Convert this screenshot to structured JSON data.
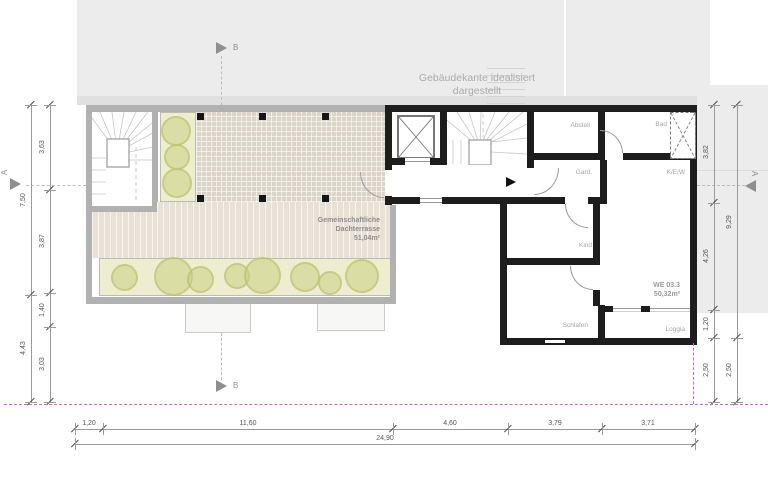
{
  "notes": {
    "building_edge_line1": "Gebäudekante idealisiert",
    "building_edge_line2": "dargestellt"
  },
  "terrace": {
    "label_line1": "Gemeinschaftliche",
    "label_line2": "Dachterrasse",
    "area": "51,04m²"
  },
  "apartment": {
    "id": "WE 03.3",
    "area": "50,32m²",
    "rooms": {
      "abstell": "Abstell",
      "bad": "Bad",
      "gard": "Gard.",
      "kew": "K/E/W",
      "kind": "Kind",
      "schlafen": "Schlafen",
      "loggia": "Loggia"
    }
  },
  "sections": {
    "a": "A",
    "b": "B"
  },
  "dimensions": {
    "left_inner": [
      "3,63",
      "3,87",
      "1,40",
      "3,03"
    ],
    "left_outer": [
      "7,50",
      "4,43"
    ],
    "right_inner": [
      "3,82",
      "4,26",
      "1,20",
      "2,50"
    ],
    "right_outer": [
      "9,29",
      "2,50"
    ],
    "bottom": [
      "1,20",
      "11,60",
      "4,60",
      "3,79",
      "3,71"
    ],
    "bottom_total": "24,90"
  },
  "colors": {
    "wall": "#1d1d1d",
    "terrace_wall": "#b1b1b1",
    "context_gray": "#ececec",
    "deck": "#e8e1d5",
    "planter": "#ededcf",
    "bush": "#cbd182",
    "property_line": "#d45fd4",
    "dimension": "#9a9a9a"
  }
}
